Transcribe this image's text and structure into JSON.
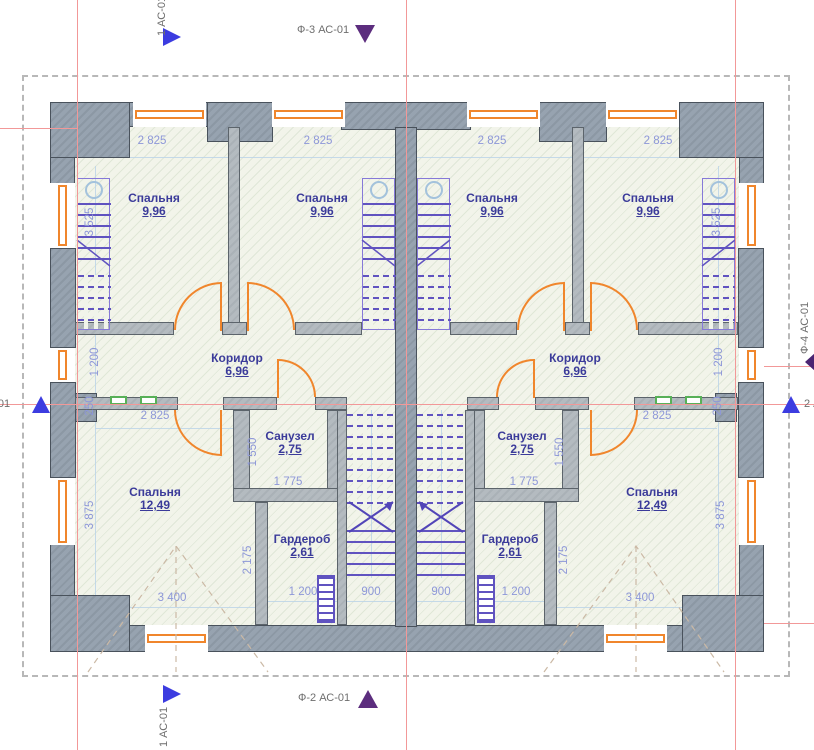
{
  "colors": {
    "wall_gray": "#97a3b0",
    "partition_gray": "#b4bbc0",
    "window_orange": "#f0862c",
    "grid_red": "#f29898",
    "dim_blue": "#8d97d8",
    "room_navy": "#3b3b9a",
    "stair_purple": "#6053c0",
    "section_marker_blue": "#3c3ce0",
    "facade_marker_purple": "#5c2d7e",
    "radiator_green": "#58b058"
  },
  "markers": {
    "section_vertical_label": "1 АС-01",
    "section_horizontal_label": "2 АС-01",
    "facade_top_label": "Ф-3 АС-01",
    "facade_bottom_label": "Ф-2 АС-01",
    "facade_right_label": "Ф-4 АС-01"
  },
  "plan": {
    "rooms": [
      {
        "name": "bedroom-1",
        "label": "Спальня",
        "area": "9,96",
        "x": 154,
        "y": 192
      },
      {
        "name": "bedroom-2",
        "label": "Спальня",
        "area": "9,96",
        "x": 322,
        "y": 192
      },
      {
        "name": "bedroom-3",
        "label": "Спальня",
        "area": "9,96",
        "x": 492,
        "y": 192
      },
      {
        "name": "bedroom-4",
        "label": "Спальня",
        "area": "9,96",
        "x": 648,
        "y": 192
      },
      {
        "name": "corridor-left",
        "label": "Коридор",
        "area": "6,96",
        "x": 237,
        "y": 352
      },
      {
        "name": "corridor-right",
        "label": "Коридор",
        "area": "6,96",
        "x": 575,
        "y": 352
      },
      {
        "name": "bathroom-left",
        "label": "Санузел",
        "area": "2,75",
        "x": 290,
        "y": 430
      },
      {
        "name": "bathroom-right",
        "label": "Санузел",
        "area": "2,75",
        "x": 522,
        "y": 430
      },
      {
        "name": "wardrobe-left",
        "label": "Гардероб",
        "area": "2,61",
        "x": 302,
        "y": 533
      },
      {
        "name": "wardrobe-right",
        "label": "Гардероб",
        "area": "2,61",
        "x": 510,
        "y": 533
      },
      {
        "name": "bedroom-5",
        "label": "Спальня",
        "area": "12,49",
        "x": 155,
        "y": 486
      },
      {
        "name": "bedroom-6",
        "label": "Спальня",
        "area": "12,49",
        "x": 652,
        "y": 486
      }
    ],
    "dimensions": [
      {
        "text": "2 825",
        "x": 152,
        "y": 141
      },
      {
        "text": "2 825",
        "x": 318,
        "y": 141
      },
      {
        "text": "2 825",
        "x": 492,
        "y": 141
      },
      {
        "text": "2 825",
        "x": 658,
        "y": 141
      },
      {
        "text": "3 525",
        "x": 90,
        "y": 222,
        "rot": true
      },
      {
        "text": "3 525",
        "x": 717,
        "y": 222,
        "rot": true
      },
      {
        "text": "1 200",
        "x": 95,
        "y": 362,
        "rot": true
      },
      {
        "text": "1 200",
        "x": 719,
        "y": 362,
        "rot": true
      },
      {
        "text": "250",
        "x": 90,
        "y": 406,
        "rot": true
      },
      {
        "text": "250",
        "x": 718,
        "y": 406,
        "rot": true
      },
      {
        "text": "2 825",
        "x": 155,
        "y": 416
      },
      {
        "text": "2 825",
        "x": 657,
        "y": 416
      },
      {
        "text": "1 550",
        "x": 253,
        "y": 452,
        "rot": true
      },
      {
        "text": "1 550",
        "x": 560,
        "y": 452,
        "rot": true
      },
      {
        "text": "1 775",
        "x": 288,
        "y": 482
      },
      {
        "text": "1 775",
        "x": 524,
        "y": 482
      },
      {
        "text": "2 175",
        "x": 248,
        "y": 560,
        "rot": true
      },
      {
        "text": "2 175",
        "x": 564,
        "y": 560,
        "rot": true
      },
      {
        "text": "3 875",
        "x": 90,
        "y": 515,
        "rot": true
      },
      {
        "text": "3 875",
        "x": 721,
        "y": 515,
        "rot": true
      },
      {
        "text": "3 400",
        "x": 172,
        "y": 598
      },
      {
        "text": "3 400",
        "x": 640,
        "y": 598
      },
      {
        "text": "1 200",
        "x": 303,
        "y": 592
      },
      {
        "text": "1 200",
        "x": 516,
        "y": 592
      },
      {
        "text": "900",
        "x": 371,
        "y": 592
      },
      {
        "text": "900",
        "x": 441,
        "y": 592
      }
    ]
  }
}
